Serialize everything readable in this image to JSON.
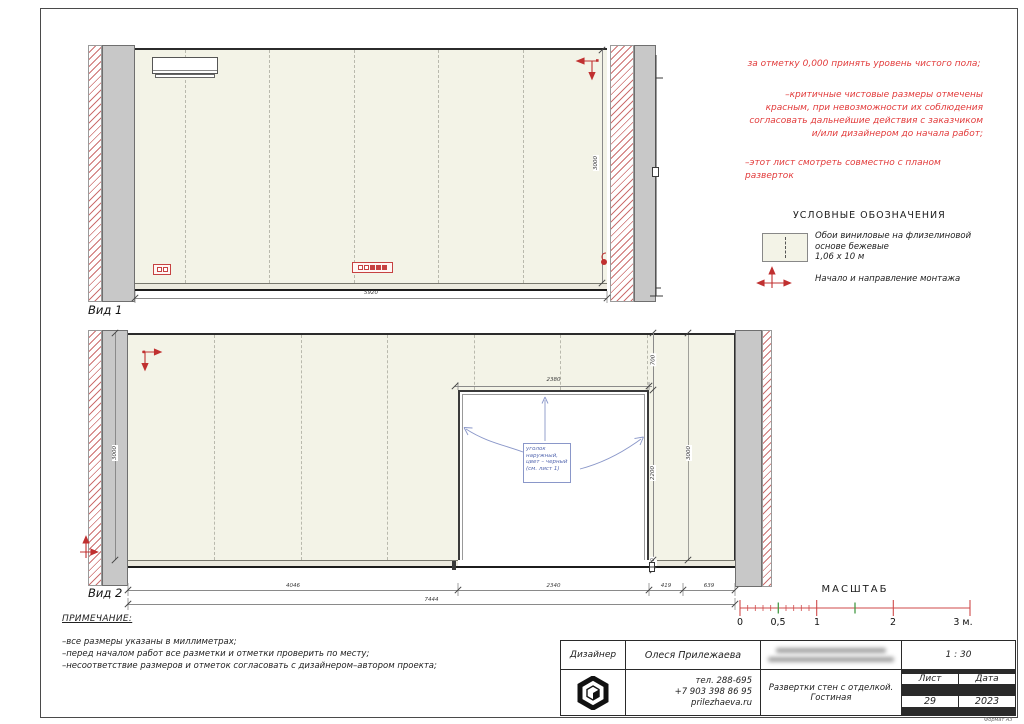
{
  "views": {
    "view1": {
      "label": "Вид 1",
      "width": "5920",
      "height": "3000"
    },
    "view2": {
      "label": "Вид 2",
      "total_width": "7444",
      "segments": [
        "4046",
        "2340",
        "419",
        "639"
      ],
      "door_width": "2380",
      "above_door": "700",
      "door_height": "2200",
      "baseboard": "100",
      "height_left": "3000",
      "height_right": "3000",
      "callout": "уголок наружный, цвет – черный (см. лист 1)"
    }
  },
  "annotations": {
    "red_notes": [
      "за отметку 0,000 принять уровень чистого пола;",
      "–критичные чистовые размеры отмечены красным, при невозможности их соблюдения согласовать дальнейшие действия с заказчиком и/или дизайнером до начала работ;",
      "–этот лист смотреть совместно с планом разверток"
    ]
  },
  "legend": {
    "title": "УСЛОВНЫЕ ОБОЗНАЧЕНИЯ",
    "wallpaper_name": "Обои виниловые на флизелиновой основе бежевые",
    "wallpaper_size": "1,06 х 10 м",
    "montage_label": "Начало и направление монтажа"
  },
  "scalebar": {
    "title": "МАСШТАБ",
    "labels": [
      "0",
      "0,5",
      "1",
      "2",
      "3 м."
    ]
  },
  "notes": {
    "title": "ПРИМЕЧАНИЕ:",
    "lines": [
      "–все размеры указаны в миллиметрах;",
      "–перед началом работ все разметки и отметки проверить по месту;",
      "–несоответствие размеров и отметок согласовать с дизайнером–автором проекта;"
    ]
  },
  "titleblock": {
    "designer_label": "Дизайнер",
    "designer_name": "Олеся Прилежаева",
    "phone1": "тел. 288-695",
    "phone2": "+7 903 398 86 95",
    "site": "prilezhaeva.ru",
    "drawing_title": "Развертки стен с отделкой. Гостиная",
    "scale": "1 : 30",
    "sheet_label": "Лист",
    "date_label": "Дата",
    "sheet_number": "29",
    "year": "2023",
    "format": "Формат А3"
  },
  "colors": {
    "red_accent": "#e23b3b",
    "wall_fill": "#f3f3e7",
    "column_gray": "#c8c8c8",
    "callout_blue": "#5568b0",
    "scale_green": "#459a45"
  }
}
